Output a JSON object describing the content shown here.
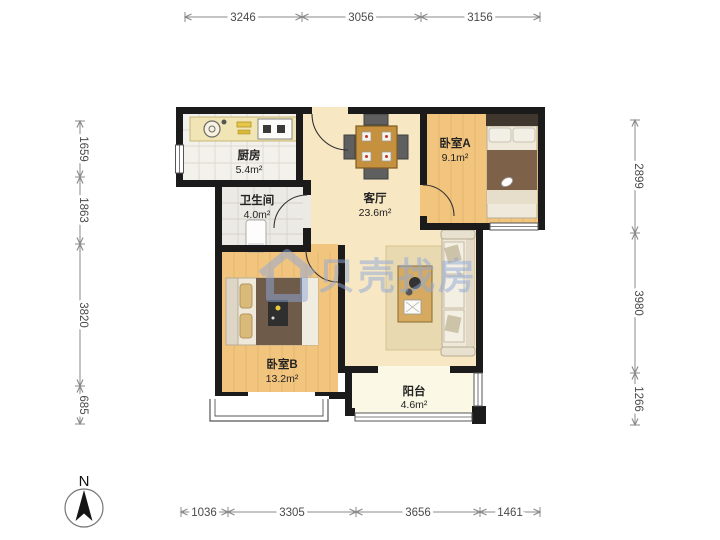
{
  "plan": {
    "rooms": {
      "kitchen": {
        "name": "厨房",
        "area": "5.4m²"
      },
      "bathroom": {
        "name": "卫生间",
        "area": "4.0m²"
      },
      "living_room": {
        "name": "客厅",
        "area": "23.6m²"
      },
      "bedroom_a": {
        "name": "卧室A",
        "area": "9.1m²"
      },
      "bedroom_b": {
        "name": "卧室B",
        "area": "13.2m²"
      },
      "balcony": {
        "name": "阳台",
        "area": "4.6m²"
      }
    }
  },
  "dimensions": {
    "top": [
      {
        "value": "3246"
      },
      {
        "value": "3056"
      },
      {
        "value": "3156"
      }
    ],
    "bottom": [
      {
        "value": "1036"
      },
      {
        "value": "3305"
      },
      {
        "value": "3656"
      },
      {
        "value": "1461"
      }
    ],
    "left": [
      {
        "value": "1659"
      },
      {
        "value": "1863"
      },
      {
        "value": "3820"
      },
      {
        "value": "685"
      }
    ],
    "right": [
      {
        "value": "2899"
      },
      {
        "value": "3980"
      },
      {
        "value": "1266"
      }
    ]
  },
  "watermark": {
    "brand": "贝壳找房"
  },
  "compass": {
    "label": "N"
  },
  "colors": {
    "wall": "#1b1b1b",
    "wood_floor": "#f2c57e",
    "living_floor": "#f7e7c3",
    "tile_floor": "#f3f1ec",
    "balcony_floor": "#fbf8e6",
    "watermark_accent": "#8fa9da"
  }
}
